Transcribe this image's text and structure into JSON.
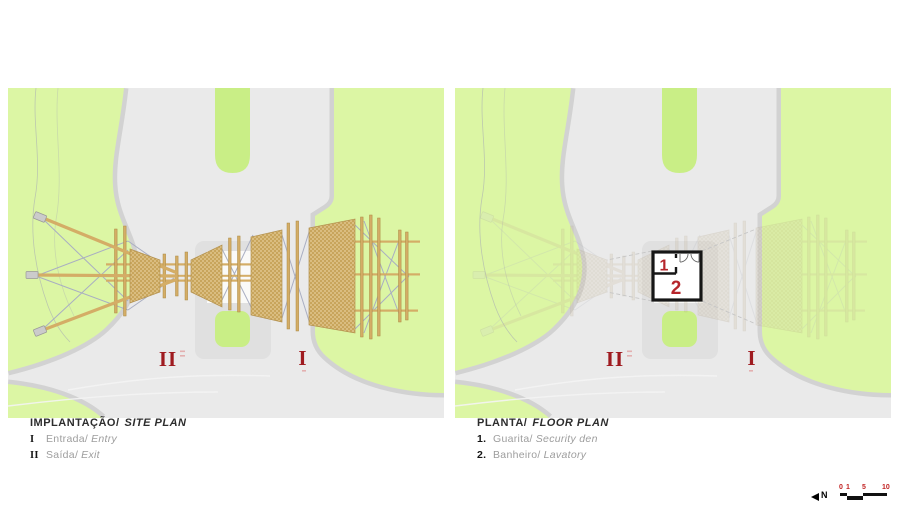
{
  "site_plan": {
    "title_pt": "IMPLANTAÇÃO/",
    "title_en": "SITE PLAN",
    "items": [
      {
        "key": "I",
        "pt": "Entrada/",
        "en": "Entry"
      },
      {
        "key": "II",
        "pt": "Saída/",
        "en": "Exit"
      }
    ],
    "labels": {
      "exit": "II",
      "entry": "I"
    }
  },
  "floor_plan": {
    "title_pt": "PLANTA/",
    "title_en": "FLOOR PLAN",
    "items": [
      {
        "key": "1.",
        "pt": "Guarita/",
        "en": "Security den"
      },
      {
        "key": "2.",
        "pt": "Banheiro/",
        "en": "Lavatory"
      }
    ],
    "labels": {
      "exit": "II",
      "entry": "I"
    },
    "rooms": {
      "guardhouse": "1",
      "lavatory": "2"
    }
  },
  "compass": {
    "label": "N"
  },
  "scale_bar": {
    "ticks": [
      "0",
      "1",
      "5",
      "10"
    ]
  },
  "colors": {
    "field_green": "#dcf6a4",
    "median_green": "#c9ee86",
    "road_gray": "#eaeaea",
    "curb_gray": "#d2d2d2",
    "platform_gray": "#e0e0e0",
    "wood_tan": "#d4ad66",
    "mesh_tan": "#dabd80",
    "cable_gray": "#a9aec2",
    "label_red": "#9f1b20",
    "number_red": "#b6252b",
    "scale_red": "#c22222"
  }
}
